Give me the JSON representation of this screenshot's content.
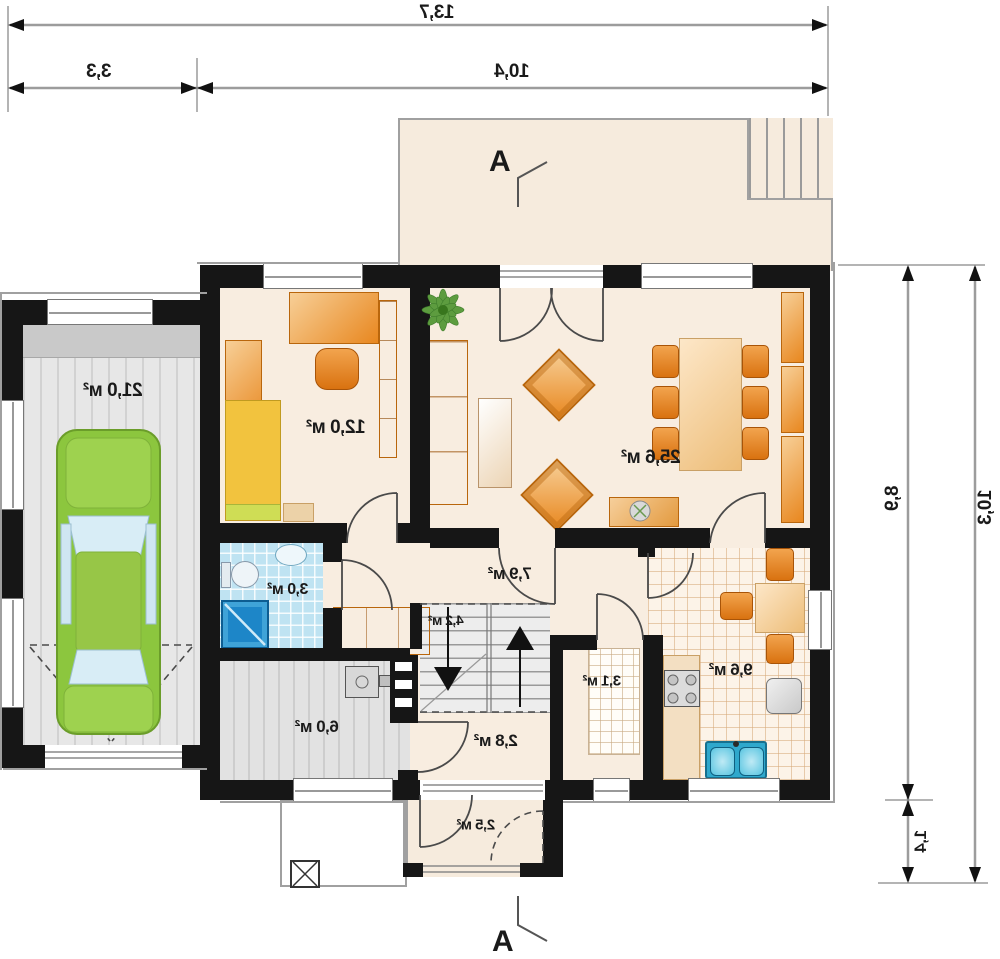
{
  "plan": {
    "section_marker": "A",
    "dimensions": {
      "total_width": "13,7",
      "garage_width": "3,3",
      "house_width": "10,4",
      "house_depth": "8,9",
      "porch_depth": "1,4",
      "total_depth": "10,3"
    },
    "rooms": {
      "garage": {
        "area": "21,0 м²"
      },
      "bedroom": {
        "area": "12,0 м²"
      },
      "living": {
        "area": "25,6 м²"
      },
      "bathroom": {
        "area": "3,0 м²"
      },
      "hall": {
        "area": "7,9 м²"
      },
      "stairs": {
        "area": "4,2 м²"
      },
      "boiler": {
        "area": "6,0 м²"
      },
      "entry": {
        "area": "2,8 м²"
      },
      "pantry": {
        "area": "3,1 м²"
      },
      "kitchen": {
        "area": "9,6 м²"
      },
      "porch": {
        "area": "2,5 м²"
      }
    },
    "colors": {
      "wall": "#161616",
      "floor": "#f8ede0",
      "furniture": "#e8871f",
      "bath_tile": "#bfe3f2",
      "car": "#8cc63e",
      "dim_line": "#9c9c9c"
    }
  }
}
